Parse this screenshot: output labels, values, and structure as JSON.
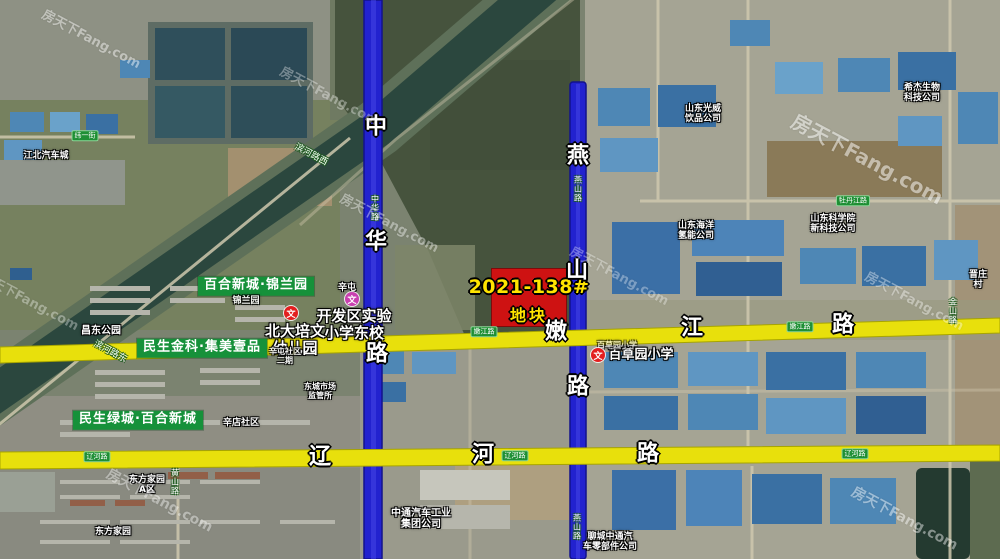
{
  "map": {
    "type": "annotated-satellite-map",
    "plot": {
      "line1": "2021-138#",
      "line2": "地块",
      "fill_color": "#ce1212",
      "text_color": "#ffe400"
    },
    "watermark": {
      "text": "房天下Fang.com",
      "positions": [
        {
          "x": 92,
          "y": 38,
          "size": 13,
          "opacity": 0.45
        },
        {
          "x": 330,
          "y": 95,
          "size": 13,
          "opacity": 0.35
        },
        {
          "x": 390,
          "y": 222,
          "size": 13,
          "opacity": 0.4
        },
        {
          "x": 868,
          "y": 158,
          "size": 20,
          "opacity": 0.5
        },
        {
          "x": 915,
          "y": 300,
          "size": 13,
          "opacity": 0.38
        },
        {
          "x": 905,
          "y": 518,
          "size": 14,
          "opacity": 0.45
        },
        {
          "x": 160,
          "y": 500,
          "size": 14,
          "opacity": 0.4
        },
        {
          "x": 620,
          "y": 275,
          "size": 13,
          "opacity": 0.33
        },
        {
          "x": 30,
          "y": 300,
          "size": 13,
          "opacity": 0.35
        }
      ]
    },
    "roads": [
      {
        "name": "中华路",
        "orientation": "vertical",
        "color": "#2222cf"
      },
      {
        "name": "燕山路",
        "orientation": "vertical",
        "color": "#2222cf"
      },
      {
        "name": "嫩江路",
        "orientation": "horizontal",
        "color": "#e8e00c"
      },
      {
        "name": "辽河路",
        "orientation": "horizontal",
        "color": "#e8e00c"
      },
      {
        "name": "牡丹江路",
        "orientation": "horizontal",
        "color": "#cfc8ae"
      },
      {
        "name": "黄山路",
        "orientation": "vertical",
        "color": "#cfc8ae"
      },
      {
        "name": "金山路",
        "orientation": "vertical",
        "color": "#cfc8ae"
      },
      {
        "name": "纬一街",
        "orientation": "horizontal",
        "color": "#cfc8ae"
      },
      {
        "name": "滨河路东",
        "orientation": "diagonal",
        "color": "#cfc8ae"
      },
      {
        "name": "滨河路西",
        "orientation": "diagonal",
        "color": "#cfc8ae"
      }
    ],
    "school_icon_glyph": "文",
    "school_icons": [
      {
        "x": 291,
        "y": 313,
        "color": "#e31f1f"
      },
      {
        "x": 352,
        "y": 299,
        "color": "#c93fb0"
      },
      {
        "x": 598,
        "y": 355,
        "color": "#e31f1f"
      }
    ],
    "labels": [
      {
        "type": "estate",
        "text": "百合新城·锦兰园",
        "x": 256,
        "y": 286,
        "size": 13,
        "name": "estate-label-jinlanyuan"
      },
      {
        "type": "estate",
        "text": "民生金科·集美壹品",
        "x": 202,
        "y": 348,
        "size": 13,
        "name": "estate-label-jimeiyipin"
      },
      {
        "type": "estate",
        "text": "民生绿城·百合新城",
        "x": 138,
        "y": 420,
        "size": 13,
        "name": "estate-label-baihexincheng"
      },
      {
        "type": "roadchar",
        "text": "中",
        "x": 376,
        "y": 128,
        "size": 22,
        "name": "road-zhonghua-char"
      },
      {
        "type": "roadchar",
        "text": "华",
        "x": 376,
        "y": 243,
        "size": 22,
        "name": "road-zhonghua-char"
      },
      {
        "type": "roadchar",
        "text": "路",
        "x": 377,
        "y": 355,
        "size": 22,
        "name": "road-zhonghua-char"
      },
      {
        "type": "roadchar",
        "text": "燕",
        "x": 578,
        "y": 157,
        "size": 22,
        "name": "road-yanshan-char"
      },
      {
        "type": "roadchar",
        "text": "山",
        "x": 577,
        "y": 272,
        "size": 22,
        "name": "road-yanshan-char"
      },
      {
        "type": "roadchar",
        "text": "路",
        "x": 578,
        "y": 388,
        "size": 22,
        "name": "road-yanshan-char"
      },
      {
        "type": "roadchar",
        "text": "嫩",
        "x": 556,
        "y": 333,
        "size": 22,
        "name": "road-nenjiang-char"
      },
      {
        "type": "roadchar",
        "text": "江",
        "x": 692,
        "y": 329,
        "size": 22,
        "name": "road-nenjiang-char"
      },
      {
        "type": "roadchar",
        "text": "路",
        "x": 843,
        "y": 326,
        "size": 22,
        "name": "road-nenjiang-char"
      },
      {
        "type": "roadchar",
        "text": "辽",
        "x": 320,
        "y": 458,
        "size": 22,
        "name": "road-liaohe-char"
      },
      {
        "type": "roadchar",
        "text": "河",
        "x": 483,
        "y": 456,
        "size": 22,
        "name": "road-liaohe-char"
      },
      {
        "type": "roadchar",
        "text": "路",
        "x": 648,
        "y": 455,
        "size": 22,
        "name": "road-liaohe-char"
      },
      {
        "type": "badge",
        "text": "辽河路",
        "x": 97,
        "y": 457,
        "size": 7,
        "name": "road-badge-liaohe"
      },
      {
        "type": "badge",
        "text": "辽河路",
        "x": 515,
        "y": 456,
        "size": 7,
        "name": "road-badge-liaohe"
      },
      {
        "type": "badge",
        "text": "辽河路",
        "x": 855,
        "y": 454,
        "size": 7,
        "name": "road-badge-liaohe"
      },
      {
        "type": "badge",
        "text": "嫩江路",
        "x": 484,
        "y": 332,
        "size": 7,
        "name": "road-badge-nenjiang"
      },
      {
        "type": "badge",
        "text": "嫩江路",
        "x": 800,
        "y": 327,
        "size": 7,
        "name": "road-badge-nenjiang"
      },
      {
        "type": "badge",
        "text": "牡丹江路",
        "x": 853,
        "y": 201,
        "size": 7,
        "name": "road-badge-mudanjiang"
      },
      {
        "type": "badge",
        "text": "纬一街",
        "x": 85,
        "y": 136,
        "size": 7,
        "name": "road-badge-weiyijie"
      },
      {
        "type": "vroad",
        "text": "中华路",
        "x": 374,
        "y": 208,
        "size": 8,
        "name": "road-tinylabel-zhonghua"
      },
      {
        "type": "vroad",
        "text": "燕山路",
        "x": 577,
        "y": 189,
        "size": 8,
        "name": "road-tinylabel-yanshan"
      },
      {
        "type": "vroad",
        "text": "燕山路",
        "x": 576,
        "y": 527,
        "size": 8,
        "name": "road-tinylabel-yanshan"
      },
      {
        "type": "vroad",
        "text": "黄山路",
        "x": 174,
        "y": 482,
        "size": 8,
        "name": "road-tinylabel-huangshan"
      },
      {
        "type": "vroad",
        "text": "金山路",
        "x": 952,
        "y": 311,
        "size": 8,
        "name": "road-tinylabel-jinshan"
      },
      {
        "type": "diag",
        "text": "滨河路东",
        "x": 110,
        "y": 352,
        "size": 9,
        "rot": 28,
        "name": "road-tinylabel-binhedong"
      },
      {
        "type": "diag",
        "text": "滨河路西",
        "x": 311,
        "y": 155,
        "size": 9,
        "rot": 28,
        "name": "road-tinylabel-binhexi"
      },
      {
        "type": "poi",
        "text": "开发区实验\n小学东校",
        "x": 354,
        "y": 325,
        "size": 15,
        "name": "poi-kaifaqu-shiyan-school"
      },
      {
        "type": "poi",
        "text": "北大培文\n幼儿园",
        "x": 295,
        "y": 340,
        "size": 15,
        "name": "poi-beida-peiwen-kindergarten"
      },
      {
        "type": "poi",
        "text": "百草园小学",
        "x": 641,
        "y": 356,
        "size": 13,
        "name": "poi-baicaoyuan-school"
      },
      {
        "type": "poi",
        "text": "百草园小学",
        "x": 617,
        "y": 346,
        "size": 8,
        "opacity": 0.7,
        "name": "poi-baicaoyuan-school-faint"
      },
      {
        "type": "poi",
        "text": "昌东公园",
        "x": 101,
        "y": 331,
        "size": 10,
        "name": "poi-changdong-park"
      },
      {
        "type": "poi",
        "text": "辛屯",
        "x": 347,
        "y": 288,
        "size": 9,
        "name": "poi-xintun"
      },
      {
        "type": "poi",
        "text": "锦兰园",
        "x": 246,
        "y": 301,
        "size": 9,
        "opacity": 0.9,
        "name": "poi-jinlanyuan"
      },
      {
        "type": "poi",
        "text": "辛屯社区\n二期",
        "x": 285,
        "y": 357,
        "size": 8,
        "opacity": 0.9,
        "name": "poi-xintun-shequ"
      },
      {
        "type": "poi",
        "text": "东城市场\n监管所",
        "x": 320,
        "y": 392,
        "size": 8,
        "name": "poi-dongcheng-market-office"
      },
      {
        "type": "poi",
        "text": "辛店社区",
        "x": 241,
        "y": 423,
        "size": 9,
        "name": "poi-xindian-shequ"
      },
      {
        "type": "poi",
        "text": "江北汽车城",
        "x": 46,
        "y": 156,
        "size": 9,
        "name": "poi-jiangbei-auto-city"
      },
      {
        "type": "poi",
        "text": "东方家园\nA区",
        "x": 147,
        "y": 485,
        "size": 9,
        "name": "poi-dongfang-jiayuan-a"
      },
      {
        "type": "poi",
        "text": "东方家园",
        "x": 113,
        "y": 532,
        "size": 9,
        "name": "poi-dongfang-jiayuan"
      },
      {
        "type": "poi",
        "text": "晋庄村",
        "x": 978,
        "y": 280,
        "size": 9,
        "name": "poi-jinzhuang-village"
      },
      {
        "type": "poi",
        "text": "山东光威\n饮品公司",
        "x": 703,
        "y": 114,
        "size": 9,
        "name": "poi-guangwei-company"
      },
      {
        "type": "poi",
        "text": "希杰生物\n科技公司",
        "x": 922,
        "y": 93,
        "size": 9,
        "name": "poi-xijie-biotech"
      },
      {
        "type": "poi",
        "text": "山东海洋\n氢能公司",
        "x": 696,
        "y": 231,
        "size": 9,
        "name": "poi-haiyang-hydrogen"
      },
      {
        "type": "poi",
        "text": "山东科学院\n新科技公司",
        "x": 833,
        "y": 224,
        "size": 9,
        "name": "poi-kexueyuan-tech"
      },
      {
        "type": "poi",
        "text": "中通汽车工业\n集团公司",
        "x": 421,
        "y": 519,
        "size": 10,
        "name": "poi-zhongtong-auto-group"
      },
      {
        "type": "poi",
        "text": "聊城中通汽\n车零部件公司",
        "x": 610,
        "y": 542,
        "size": 9,
        "name": "poi-liaocheng-auto-parts"
      }
    ]
  }
}
